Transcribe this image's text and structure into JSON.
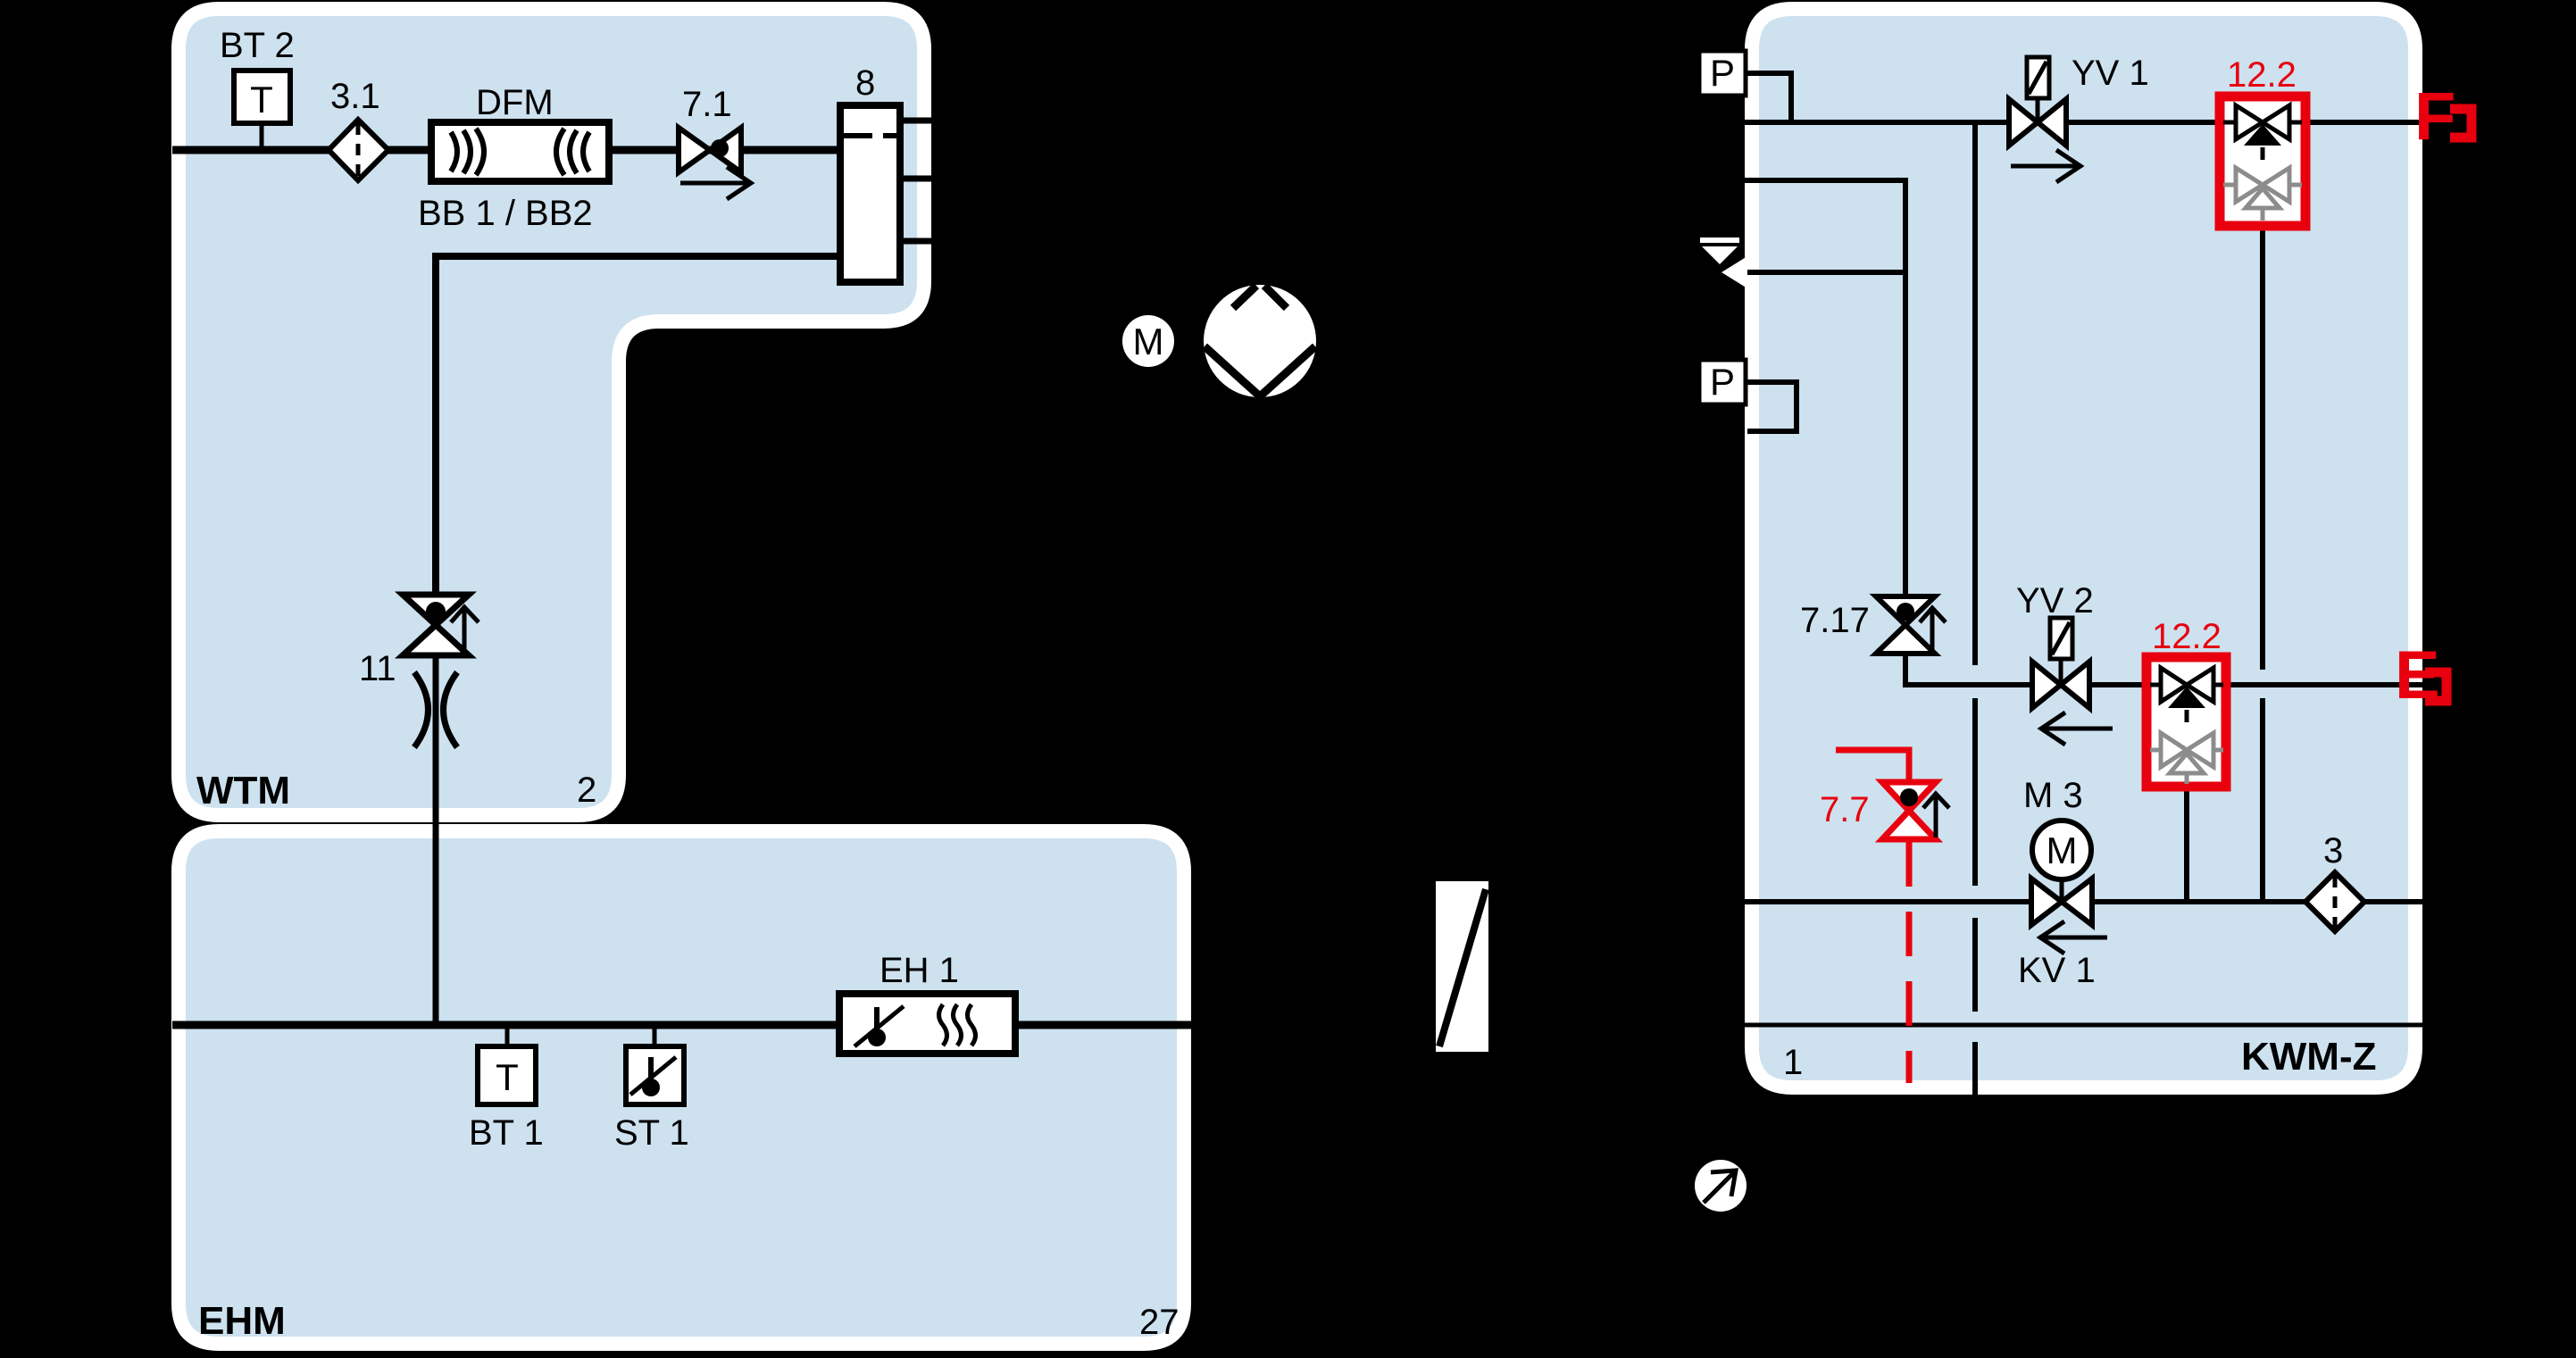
{
  "diagram": {
    "wtm": {
      "name": "WTM",
      "number": "2",
      "sensor_bt2": {
        "label": "BT 2",
        "symbol": "T"
      },
      "filter": "3.1",
      "flow_meter": {
        "label": "DFM",
        "sublabel": "BB 1 / BB2"
      },
      "check_valve": "7.1",
      "tank": "8",
      "valve": "11"
    },
    "ehm": {
      "name": "EHM",
      "number": "27",
      "sensor_bt1": {
        "label": "BT 1",
        "symbol": "T"
      },
      "sensor_st1": {
        "label": "ST 1"
      },
      "heater": {
        "label": "EH 1"
      }
    },
    "pump": {
      "motor": "M"
    },
    "kwmz": {
      "name": "KWM-Z",
      "number": "1",
      "pressure_top": "P",
      "pressure_mid": "P",
      "solenoid_yv1": "YV 1",
      "solenoid_yv2": "YV 2",
      "valve_717": "7.17",
      "valve_77": "7.7",
      "motor_valve": {
        "label": "M 3",
        "symbol": "M"
      },
      "check_valve_kv1": "KV 1",
      "filter": "3",
      "protection_top": "12.2",
      "protection_mid": "12.2",
      "connector_f": "F",
      "connector_e": "E"
    },
    "colors": {
      "background": "#000000",
      "panel_fill": "#cde1ef",
      "panel_border": "#ffffff",
      "line": "#000000",
      "accent_red": "#e8000e",
      "inactive_gray": "#8c8c8c"
    }
  }
}
